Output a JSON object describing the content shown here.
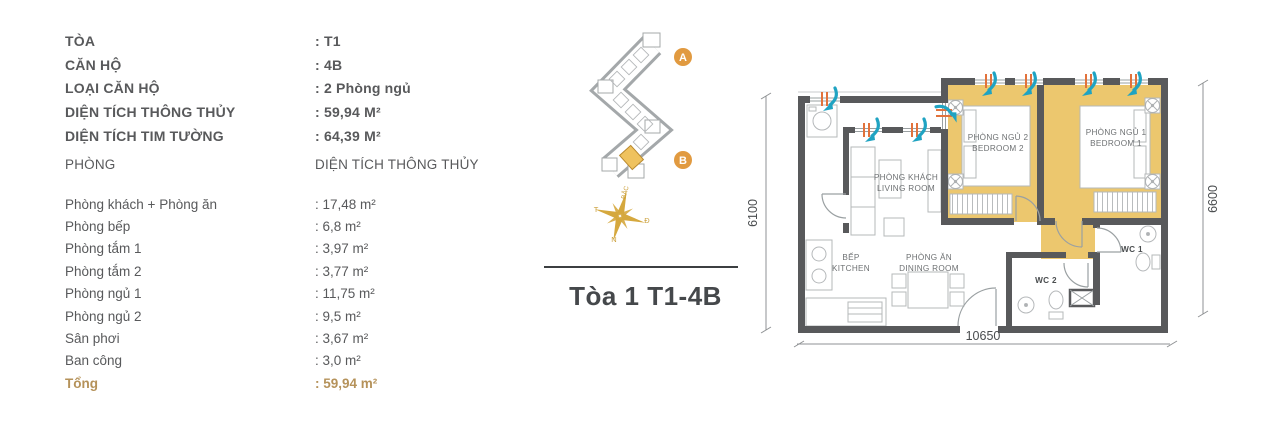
{
  "specs": {
    "rows": [
      {
        "label": "TÒA",
        "value": ": T1"
      },
      {
        "label": "CĂN HỘ",
        "value": ": 4B"
      },
      {
        "label": "LOẠI CĂN HỘ",
        "value": ": 2 Phòng ngủ"
      },
      {
        "label": "DIỆN TÍCH THÔNG THỦY",
        "value": ": 59,94 M²"
      },
      {
        "label": "DIỆN TÍCH TIM TƯỜNG",
        "value": ": 64,39 M²"
      }
    ]
  },
  "room_table": {
    "header": {
      "name": "PHÒNG",
      "area": "DIỆN TÍCH THÔNG THỦY"
    },
    "rows": [
      {
        "name": "Phòng khách + Phòng ăn",
        "area": ": 17,48 m²"
      },
      {
        "name": "Phòng bếp",
        "area": ": 6,8 m²"
      },
      {
        "name": "Phòng tắm 1",
        "area": ": 3,97 m²"
      },
      {
        "name": "Phòng tắm 2",
        "area": ": 3,77 m²"
      },
      {
        "name": "Phòng ngủ 1",
        "area": ": 11,75 m²"
      },
      {
        "name": "Phòng ngủ 2",
        "area": ": 9,5 m²"
      },
      {
        "name": "Sân phơi",
        "area": ": 3,67 m²"
      },
      {
        "name": "Ban công",
        "area": ": 3,0 m²"
      }
    ],
    "total": {
      "name": "Tổng",
      "area": ": 59,94 m²"
    }
  },
  "locator": {
    "marker_a": "A",
    "marker_b": "B",
    "compass": {
      "north": "BẮC",
      "west": "T",
      "east": "Đ",
      "south": "N"
    },
    "title": "Tòa 1 T1-4B"
  },
  "plan": {
    "rooms": {
      "living": {
        "vi": "PHÒNG KHÁCH",
        "en": "LIVING ROOM"
      },
      "kitchen": {
        "vi": "BẾP",
        "en": "KITCHEN"
      },
      "dining": {
        "vi": "PHÒNG ĂN",
        "en": "DINING ROOM"
      },
      "bedroom1": {
        "vi": "PHÒNG NGỦ 1",
        "en": "BEDROOM 1"
      },
      "bedroom2": {
        "vi": "PHÒNG NGỦ 2",
        "en": "BEDROOM 2"
      },
      "wc1": "WC 1",
      "wc2": "WC 2"
    },
    "dimensions": {
      "left": "6100",
      "right": "6600",
      "bottom": "10650"
    },
    "colors": {
      "highlight": "#ECC76E",
      "wall": "#58595B",
      "air_arrow": "#1FA3C2",
      "window_tick": "#E2723B",
      "marker": "#E19A40",
      "accent_text": "#B5925A"
    }
  }
}
